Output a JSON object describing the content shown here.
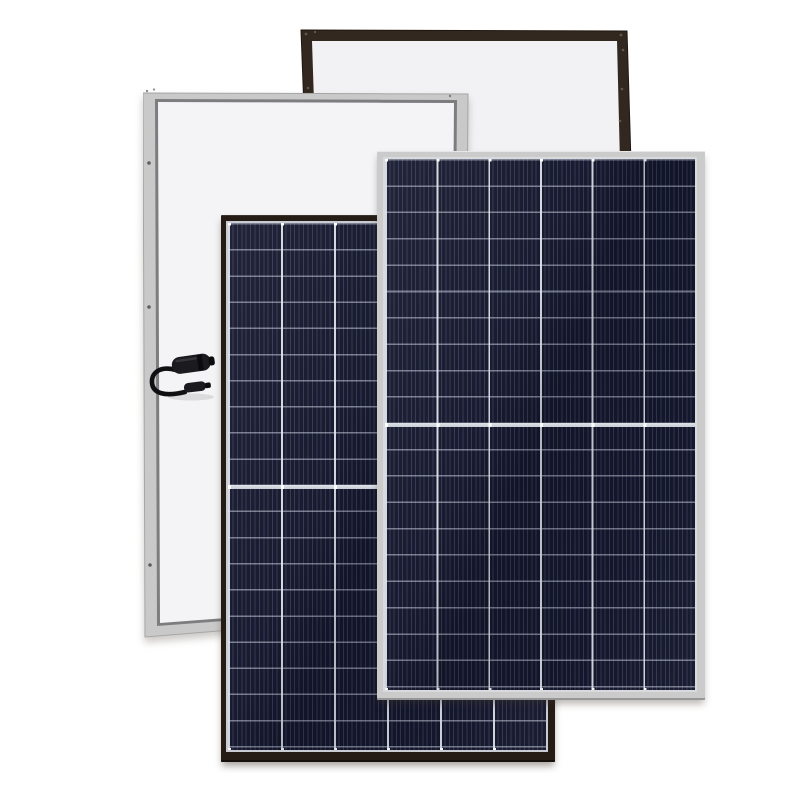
{
  "scene": {
    "description": "Product photo of four overlapping solar photovoltaic modules on a white background: two rear-view panels (dark-brown/black frame and silver frame, white backsheets, the silver one with a looped junction cable carrying two MC4 connectors) behind two front-view panels (black frame and silver frame) showing dark navy half-cut cell grids of 6 columns by 20 rows split by a central divider",
    "background_color": "#ffffff"
  },
  "cell_style": {
    "base": "#14162b",
    "stripe": "rgba(128,137,182,0.28)",
    "row_line": "rgba(196,203,218,0.55)",
    "col_line": "rgba(226,230,240,0.92)",
    "divider_top": "#e0e4ea",
    "divider_bottom": "#c6ccd5",
    "tick": "#ffffff",
    "sheen_dark": "rgba(8,10,20,0.16)",
    "sheen_light": "rgba(255,255,255,0.06)"
  },
  "panels": [
    {
      "id": "back-black",
      "label": "rear view solar module with black frame",
      "view": "back",
      "frame_color": "#33281f",
      "frame_edge_color": "#1f160f",
      "backsheet_color": "#f2f2f4",
      "screw_color": "#5f564e"
    },
    {
      "id": "back-silver",
      "label": "rear view solar module with silver frame and MC4 cable",
      "view": "back",
      "frame_color": "#c9c9c9",
      "frame_edge_color": "#a6a6a6",
      "inner_line_color": "#7d7d7f",
      "backsheet_color": "#f4f4f6",
      "screw_color": "#5e5e5e",
      "accessory": {
        "label": "junction cable loop with two MC4 connectors",
        "cable_color": "#101012",
        "connector_color": "#1b1b1f",
        "connector_count": 2
      }
    },
    {
      "id": "front-black",
      "label": "front view solar module with black frame",
      "view": "front",
      "frame_color": "#261c16",
      "frame_edge_color": "#15100c",
      "border_line_color": "#c9ccd2",
      "columns": 6,
      "rows": 20,
      "half_cut": true
    },
    {
      "id": "front-silver",
      "label": "front view solar module with silver frame",
      "view": "front",
      "frame_color": "#cbcbcb",
      "frame_edge_color": "#969696",
      "border_line_color": "#d8dadd",
      "columns": 6,
      "rows": 20,
      "half_cut": true
    }
  ]
}
